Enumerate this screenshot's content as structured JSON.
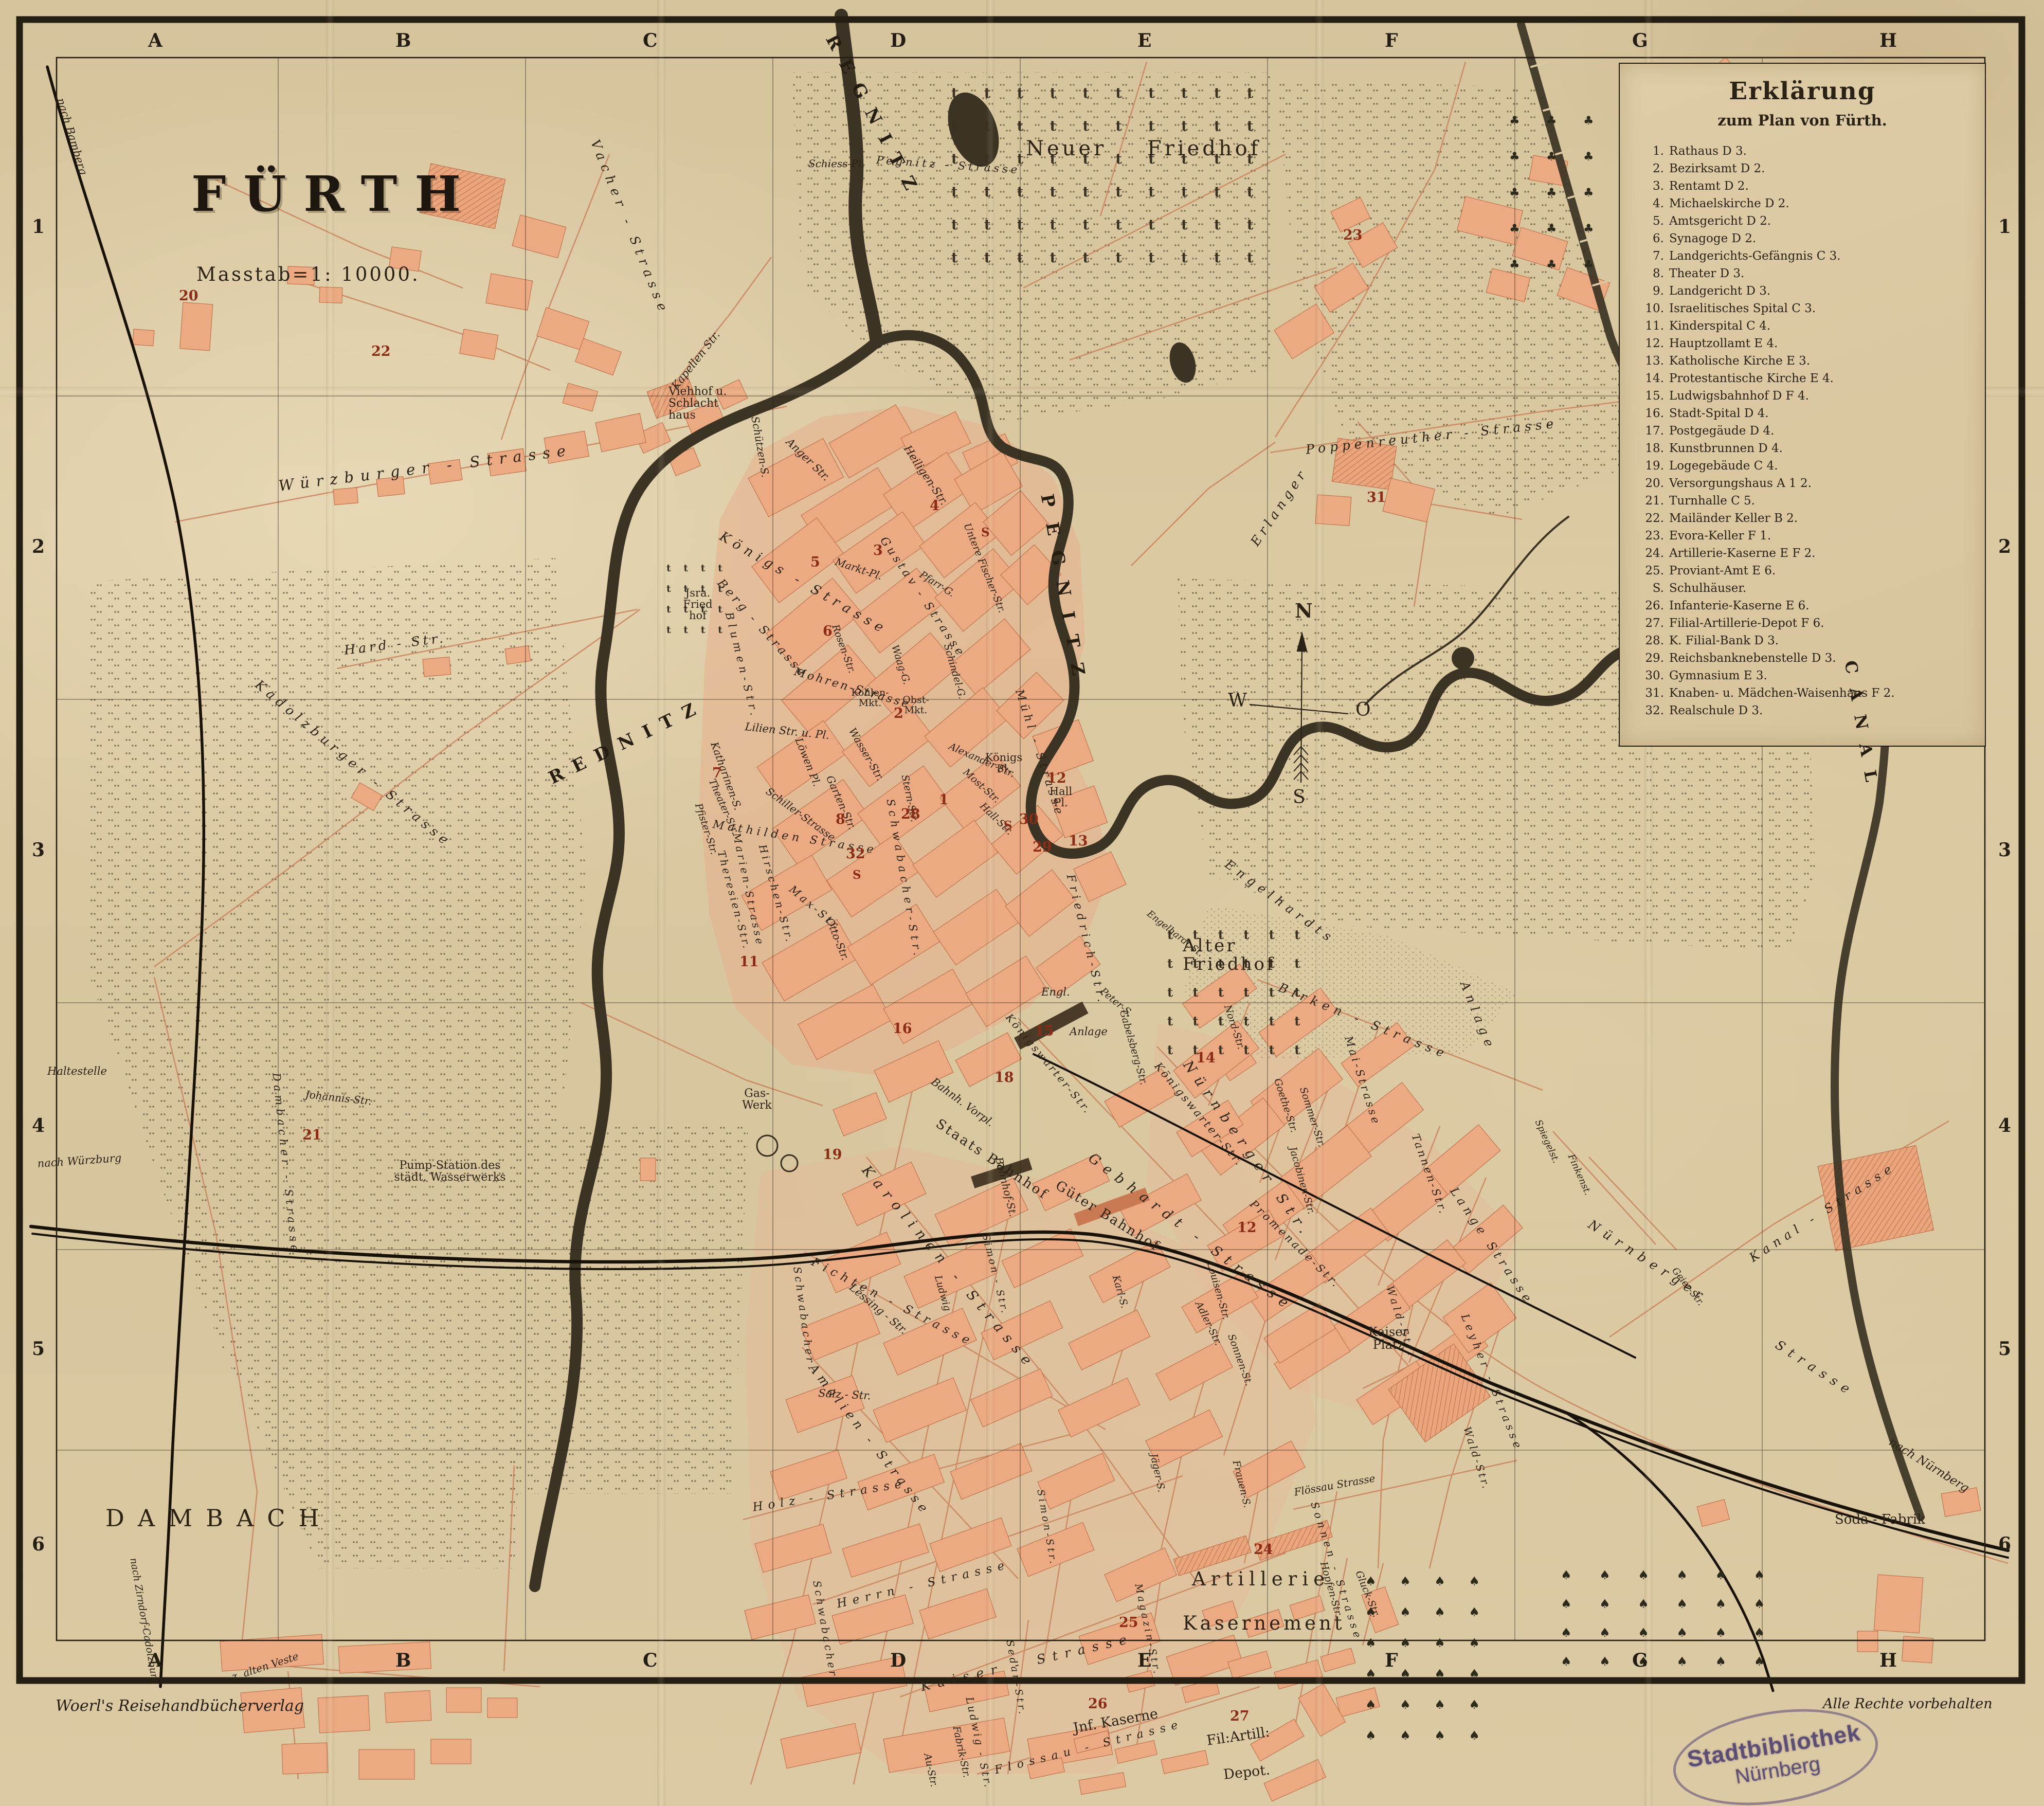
{
  "title": {
    "city": "FÜRTH",
    "scale": "Masstab=1: 10000."
  },
  "frame": {
    "columns": [
      "A",
      "B",
      "C",
      "D",
      "E",
      "F",
      "G",
      "H"
    ],
    "rows": [
      "1",
      "2",
      "3",
      "4",
      "5",
      "6"
    ]
  },
  "compass": {
    "n": "N",
    "o": "O",
    "s": "S",
    "w": "W"
  },
  "legend": {
    "title": "Erklärung",
    "subtitle": "zum Plan von Fürth.",
    "items": [
      {
        "n": "1.",
        "t": "Rathaus D 3."
      },
      {
        "n": "2.",
        "t": "Bezirksamt D 2."
      },
      {
        "n": "3.",
        "t": "Rentamt D 2."
      },
      {
        "n": "4.",
        "t": "Michaelskirche D 2."
      },
      {
        "n": "5.",
        "t": "Amtsgericht D 2."
      },
      {
        "n": "6.",
        "t": "Synagoge D 2."
      },
      {
        "n": "7.",
        "t": "Landgerichts-Gefängnis C 3."
      },
      {
        "n": "8.",
        "t": "Theater D 3."
      },
      {
        "n": "9.",
        "t": "Landgericht D 3."
      },
      {
        "n": "10.",
        "t": "Israelitisches Spital C 3."
      },
      {
        "n": "11.",
        "t": "Kinderspital C 4."
      },
      {
        "n": "12.",
        "t": "Hauptzollamt E 4."
      },
      {
        "n": "13.",
        "t": "Katholische Kirche E 3."
      },
      {
        "n": "14.",
        "t": "Protestantische Kirche E 4."
      },
      {
        "n": "15.",
        "t": "Ludwigsbahnhof D F 4."
      },
      {
        "n": "16.",
        "t": "Stadt-Spital D 4."
      },
      {
        "n": "17.",
        "t": "Postgegäude D 4."
      },
      {
        "n": "18.",
        "t": "Kunstbrunnen D 4."
      },
      {
        "n": "19.",
        "t": "Logegebäude C 4."
      },
      {
        "n": "20.",
        "t": "Versorgungshaus A 1 2."
      },
      {
        "n": "21.",
        "t": "Turnhalle C 5."
      },
      {
        "n": "22.",
        "t": "Mailänder Keller B 2."
      },
      {
        "n": "23.",
        "t": "Evora-Keller F 1."
      },
      {
        "n": "24.",
        "t": "Artillerie-Kaserne E F 2."
      },
      {
        "n": "25.",
        "t": "Proviant-Amt E 6."
      },
      {
        "n": "S.",
        "t": "Schulhäuser."
      },
      {
        "n": "26.",
        "t": "Infanterie-Kaserne E 6."
      },
      {
        "n": "27.",
        "t": "Filial-Artillerie-Depot F 6."
      },
      {
        "n": "28.",
        "t": "K. Filial-Bank D 3."
      },
      {
        "n": "29.",
        "t": "Reichsbanknebenstelle D 3."
      },
      {
        "n": "30.",
        "t": "Gymnasium E 3."
      },
      {
        "n": "31.",
        "t": "Knaben- u. Mädchen-Waisenhaus F 2."
      },
      {
        "n": "32.",
        "t": "Realschule D 3."
      }
    ]
  },
  "rivers": {
    "rednitz": "REDNITZ",
    "pegnitz": "PEGNITZ",
    "regnitz": "REGNITZ",
    "canal": "CANAL"
  },
  "places": {
    "neuer_friedhof": "Neuer Friedhof",
    "alter_friedhof": "Alter Friedhof",
    "jsra_friedhof": "Jsra. Fried hof",
    "viehhof": "Viehhof u. Schlacht haus",
    "dambach": "DAMBACH",
    "pump_station": "Pump-Station des städt. Wasserwerks",
    "gas_werk": "Gas- Werk",
    "soda_fabrik": "Soda - Fabrik",
    "kaiser_platz": "Kaiser Platz",
    "koenigs_pl": "Königs Pl.",
    "hall_pl": "Hall Pl.",
    "obst_mkt": "Obst- Mkt.",
    "kohlen_mkt": "Kohlen- Mkt.",
    "staats_bahnhof": "Staats Bahnhof",
    "gueter_bahnhof": "Güter Bahnhof",
    "bahnh_vorpl": "Bahnh. Vorpl.",
    "artillerie_1": "Artillerie",
    "artillerie_2": "Kasernement",
    "inf_kaserne": "Jnf. Kaserne",
    "fil_artill": "Fil:Artill:",
    "depot": "Depot.",
    "haltestelle": "Haltestelle",
    "alte_veste": "z. alten Veste"
  },
  "streets": {
    "wuerzburger": "Würzburger - Strasse",
    "vacher": "Vacher - Strasse",
    "hard": "Hard - Str.",
    "kadolzburger": "Kadolzburger - Strasse",
    "kapellen": "Kapellen Str.",
    "nach_bamberg": "nach Bamberg",
    "nach_wuerzburg": "nach Würzburg",
    "nach_zirndorf": "nach Zirndorf-Cadolzburg",
    "nach_nuernberg": "nach Nürnberg",
    "erlanger": "Erlanger",
    "poppenreuther": "Poppenreuther - Strasse",
    "schiess_pl": "Schiess-Pl.",
    "pegnitz_str": "Pegnitz - Strasse",
    "anger": "Anger Str.",
    "schuetzen": "Schützen-S.",
    "koenigs": "Königs - Strasse",
    "berg": "Berg - Strasse",
    "heiligen": "Heiligen-Str.",
    "markt_pl": "Markt-Pl.",
    "gustav": "Gustav - Strasse",
    "pfarr": "Pfarr-G.",
    "waag": "Waag-G.",
    "untere_fischer": "Untere Fischer-Str.",
    "schindel": "Schindel-G.",
    "mohren": "Mohren-Strasse",
    "lilien": "Lilien Str. u. Pl.",
    "loewen": "Löwen Pl.",
    "wasser": "Wasser-Str.",
    "garten": "Garten-Str.",
    "stern": "Stern-Str.",
    "katharinen": "Katharinen-S.",
    "blumen": "Blumen-Str.",
    "rosen": "Rosen-Str.",
    "muehl": "Mühl - Strasse",
    "mathilden": "Mathilden Strasse",
    "schiller": "Schiller-Strasse",
    "theater_str": "Theater-Str.",
    "pfister": "Pfister-Str.",
    "marien": "Marien-Strasse",
    "hirschen": "Hirschen-Str.",
    "theresien": "Theresien-Str.",
    "max": "Max-Str.",
    "otto": "Otto-Str.",
    "schwabacher_a": "Schwabacher-Str.",
    "schwabacher_b": "Schwabacher",
    "friedrich": "Friedrich-Str.",
    "alexander": "Alexander-Str.",
    "most": "Most-Str.",
    "hall": "Hall-Str.",
    "koenigswarter": "Königswarter-Str.",
    "bahnhof": "Bahnhof-St.",
    "gebhardt": "Gebhardt - Strasse",
    "nuernberger_a": "Nürnberger Str.",
    "promenade": "Promenade-Str.",
    "louisen": "Louisen-Str.",
    "jacobinen": "Jacobinen-Str.",
    "gabelsberg": "Gabelsberg-Str.",
    "nord": "Nord-Str.",
    "goethe": "Goethe-Str.",
    "sommer": "Sommer-Str.",
    "mai": "Mai-Strasse",
    "tannen": "Tannen-Str.",
    "lange": "Lange Strasse",
    "birken": "Birken - Strasse",
    "engelhardts": "Engelhardts",
    "anlage": "Anlage",
    "engelhardt_st": "Engelhardt St.",
    "peter": "Peter-S.",
    "engl": "Engl.",
    "karolinen": "Karolinen - Strasse",
    "lessing": "Lessing - Str.",
    "amalien": "Amalien - Strasse",
    "johannis": "Johannis-Str.",
    "dambacher": "Dambacher - Strasse",
    "fichten": "Fichten - Strasse",
    "salz": "Salz - Str.",
    "holz": "Holz - Strasse",
    "herrn": "Herrn - Strasse",
    "kaiser": "Kaiser - Strasse",
    "ludwig_a": "Ludwig",
    "ludwig_b": "Ludwig - Str.",
    "simon_a": "Simon - Str.",
    "simon_b": "Simon-Str.",
    "karl": "Karl-S.",
    "adler": "Adler-Str.",
    "sonnen_a": "Sonnen-St.",
    "sonnen_b": "Sonnen - Strasse",
    "frauen": "Frauen-S.",
    "jaeger": "Jäger-S.",
    "hopfen": "Hopfen-Str.",
    "gluck": "Gluck-Str.",
    "wald": "Wald-Str.",
    "leyher": "Leyher - Strasse",
    "flossau_a": "Flössau Strasse",
    "flossau_b": "Flossau - Strasse",
    "au": "Au-Str.",
    "fabrik": "Fabrik-Str.",
    "sedan": "Sedan-Str.",
    "magazin": "Magazin-Str.",
    "nuernberger_b": "Nürnberger",
    "nuernberger_c": "Strasse",
    "kanal_str": "Kanal - Strasse",
    "spiegel": "Spiegelst.",
    "finken": "Finkenst.",
    "geier": "Geier-Str."
  },
  "poi": {
    "p1": "1",
    "p2": "2",
    "p3": "3",
    "p4": "4",
    "p5": "5",
    "p6": "6",
    "p7": "7",
    "p8": "8",
    "p11": "11",
    "p12": "12",
    "p13": "13",
    "p14": "14",
    "p15": "15",
    "p16": "16",
    "p18": "18",
    "p19": "19",
    "p20": "20",
    "p21": "21",
    "p22": "22",
    "p23": "23",
    "p24": "24",
    "p25": "25",
    "p26": "26",
    "p27": "27",
    "p28": "28",
    "p29": "29",
    "p30": "30",
    "p31": "31",
    "p32": "32",
    "s": "S"
  },
  "symbols": {
    "crosses": "t t t t t t t t t t t t t t t t t t t t t t t t t t t t t t t t t t t t t t t t t t t t t t t t t t t t t t t t t t t t",
    "pines": "♠ ♠ ♠ ♠ ♠ ♠ ♠ ♠ ♠ ♠ ♠ ♠ ♠ ♠ ♠ ♠ ♠ ♠ ♠ ♠ ♠ ♠ ♠ ♠ ♠ ♠ ♠ ♠ ♠ ♠",
    "leafs": "♣ ♣ ♣ ♣ ♣ ♣ ♣ ♣ ♣ ♣ ♣ ♣ ♣ ♣ ♣ ♣ ♣ ♣ ♣ ♣ ♣ ♣ ♣ ♣"
  },
  "footer": {
    "publisher": "Woerl's Reisehandbücherverlag",
    "rights": "Alle Rechte vorbehalten"
  },
  "stamp": {
    "l1": "Stadtbibliothek",
    "l2": "Nürnberg"
  }
}
